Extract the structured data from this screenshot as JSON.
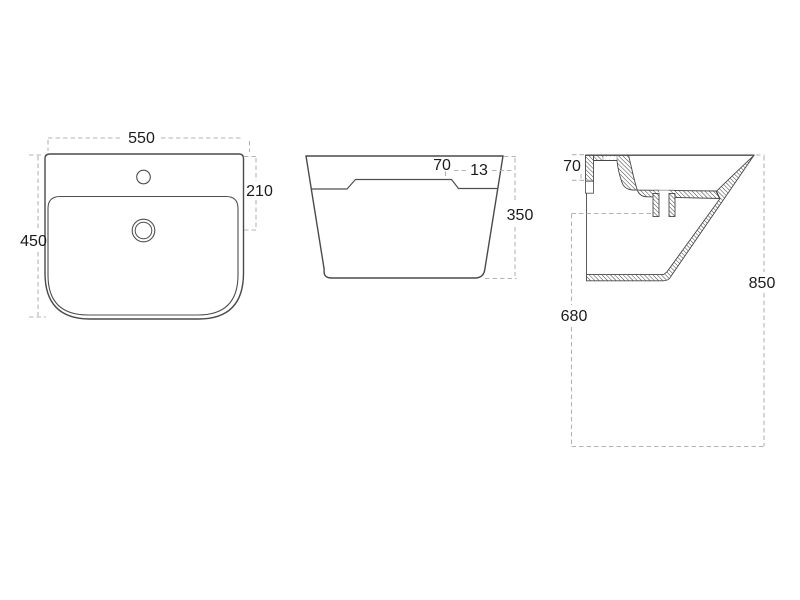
{
  "page": {
    "background_color": "#ffffff"
  },
  "drawing": {
    "line_color": "#4a4a4a",
    "dash_color": "#b4b4b4",
    "text_color": "#1c1c1c",
    "views": {
      "top": {
        "dims": {
          "width": "550",
          "depth": "450",
          "drain_offset": "210"
        }
      },
      "front": {
        "dims": {
          "deck_height": "70",
          "step": "13",
          "height": "350"
        }
      },
      "side": {
        "dims": {
          "mount_height": "70",
          "outlet_to_floor": "680",
          "rim_to_floor": "850"
        }
      }
    }
  }
}
